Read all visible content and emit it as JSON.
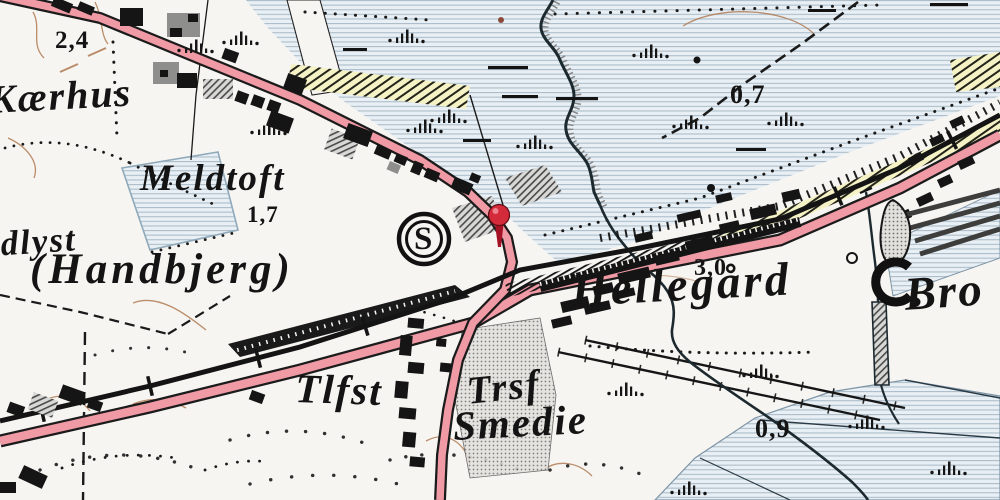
{
  "labels": {
    "kaerhus": "Kærhus",
    "meldtoft": "Meldtoft",
    "handbjerg": "(Handbjerg)",
    "ndlyst": "ndlyst",
    "tlfst": "Tlfst",
    "trsf": "Trsf",
    "smedie": "Smedie",
    "hellegaard": "Hellegård",
    "bro": "Bro",
    "station_letter": "S"
  },
  "spot_heights": {
    "n24": "2,4",
    "n17": "1,7",
    "n30": "3,0",
    "n07": "0,7",
    "n09": "0,9"
  },
  "marker": {
    "type": "map-pin",
    "color": "#d42b3a"
  },
  "colors": {
    "paper": "#f7f5f2",
    "road_pink": "#ef9aa5",
    "water_blue": "#e9f0f5",
    "marsh_yellow": "#f5f3c6",
    "ink": "#1a1a1a",
    "contour_brown": "#b07a52"
  }
}
